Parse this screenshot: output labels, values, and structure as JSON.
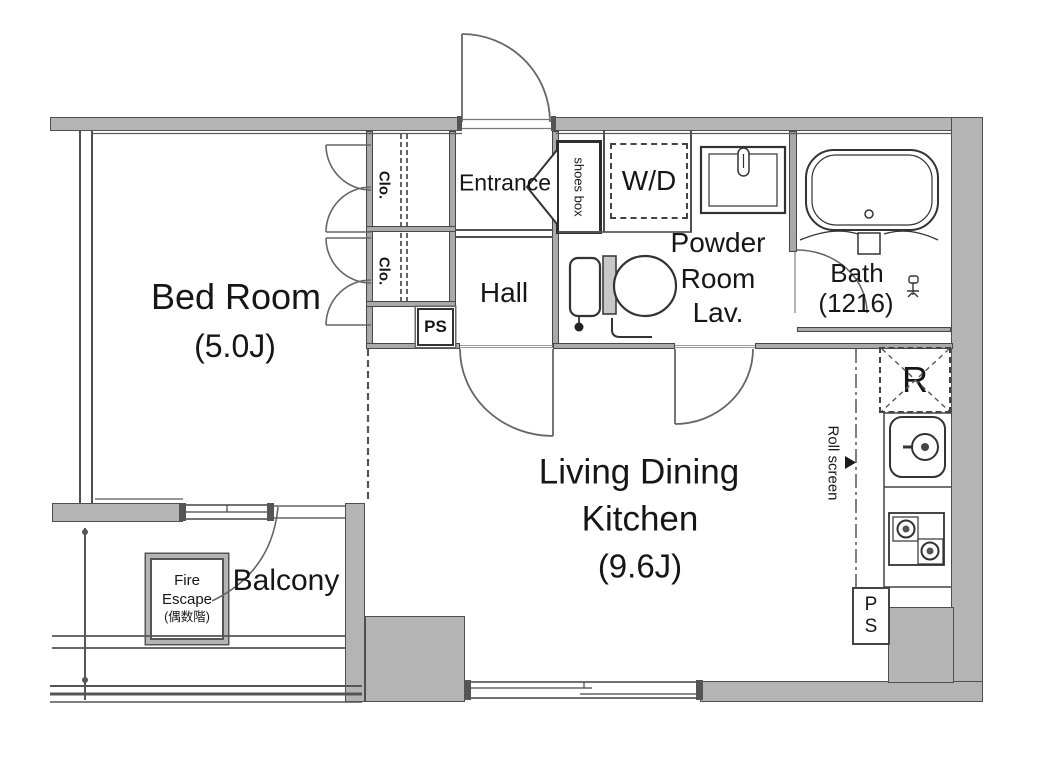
{
  "colors": {
    "wall_fill": "#b4b4b4",
    "wall_edge": "#4f4f4f",
    "line": "#474747",
    "text": "#161616",
    "background": "#ffffff"
  },
  "rooms": {
    "bedroom": {
      "name": "Bed Room",
      "size": "(5.0J)"
    },
    "entrance": {
      "name": "Entrance"
    },
    "hall": {
      "name": "Hall"
    },
    "ldk": {
      "line1": "Living Dining",
      "line2": "Kitchen",
      "size": "(9.6J)"
    },
    "powder_room": {
      "line1": "Powder",
      "line2": "Room",
      "line3": "Lav."
    },
    "bath": {
      "name": "Bath",
      "size": "(1216)"
    },
    "balcony": {
      "name": "Balcony"
    }
  },
  "features": {
    "closet_top": "Clo.",
    "closet_bottom": "Clo.",
    "shoes_box": "shoes box",
    "washer_dryer": "W/D",
    "refrigerator": "R",
    "roll_screen": "Roll screen",
    "pipe_space_hall": "PS",
    "pipe_space_kitchen": "PS",
    "fire_escape": {
      "line1": "Fire",
      "line2": "Escape",
      "line3": "(偶数階)"
    }
  }
}
